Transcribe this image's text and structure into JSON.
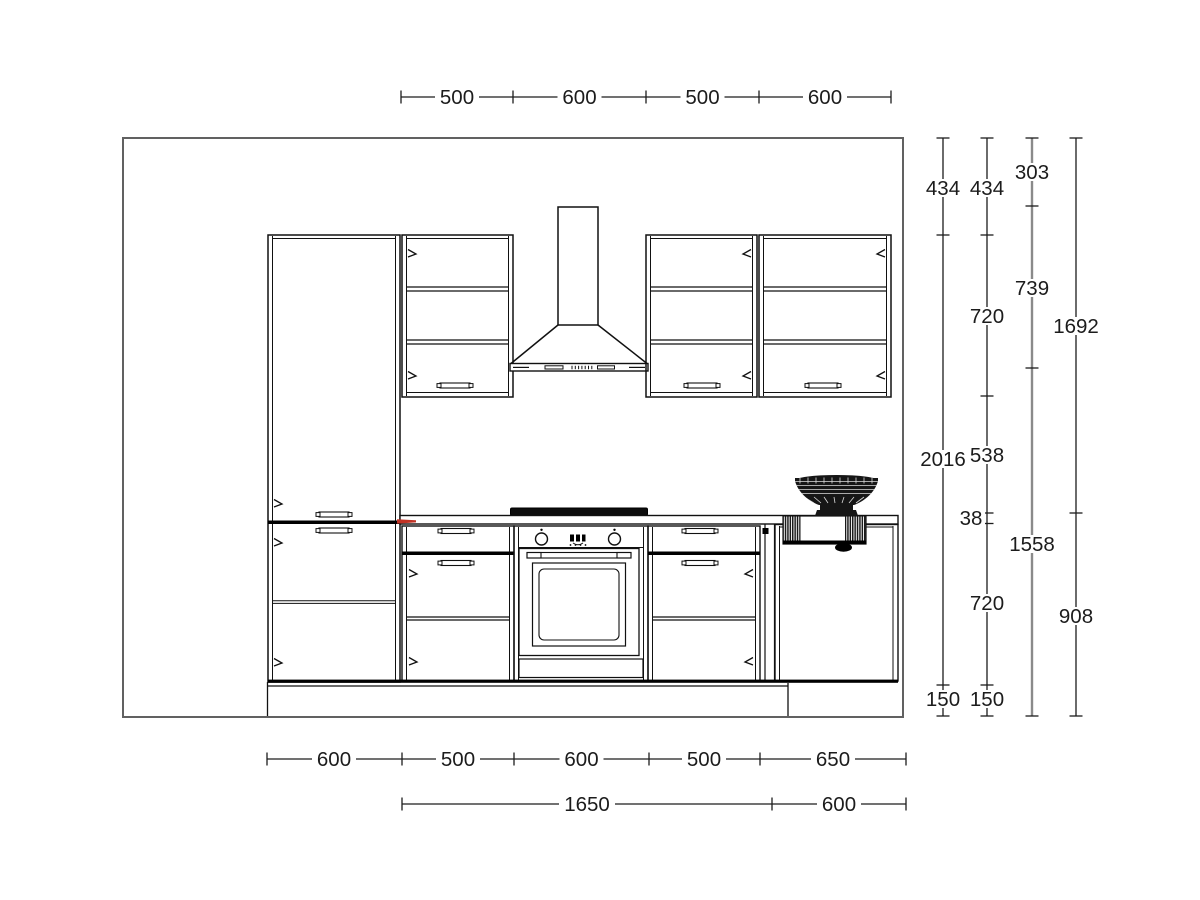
{
  "drawing": {
    "kind": "kitchen-elevation-technical-drawing",
    "units": "mm"
  },
  "colors": {
    "background": "#ffffff",
    "cabinet_line": "#111111",
    "wall_line": "#5f5f5f",
    "dim_line": "#1c1c1c",
    "hood_dim_line_gray": "#8a8a8a",
    "accent_red": "#c13325",
    "fixture_black": "#141414"
  },
  "dims": {
    "top": [
      "500",
      "600",
      "500",
      "600"
    ],
    "bottom_outer": [
      "600",
      "500",
      "600",
      "500",
      "650"
    ],
    "bottom_inner": [
      "1650",
      "600"
    ],
    "right_wall": [
      "434",
      "2016",
      "150"
    ],
    "right_cabinets": [
      "434",
      "720",
      "538",
      "38",
      "720",
      "150"
    ],
    "right_hood": [
      "303",
      "739",
      "1558"
    ],
    "right_worktop": [
      "1692",
      "908"
    ]
  }
}
